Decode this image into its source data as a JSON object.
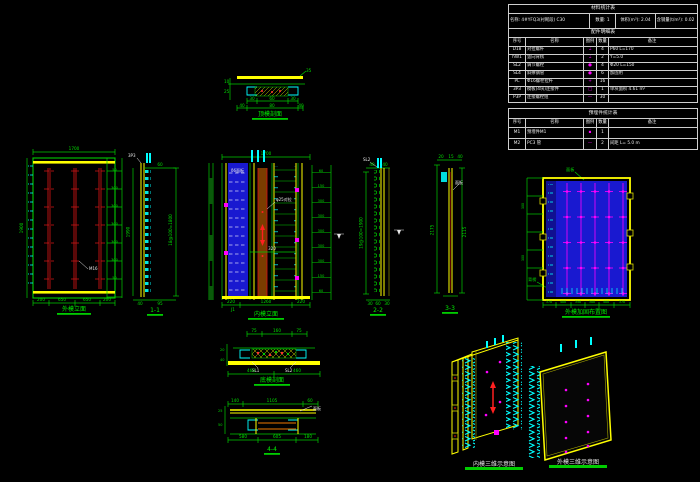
{
  "canvas": {
    "background": "#000000",
    "accent_green": "#00cc00",
    "accent_yellow": "#ffff00",
    "accent_cyan": "#00ffff",
    "accent_blue": "#1919d0",
    "accent_magenta": "#ff00ff",
    "accent_red": "#c81414"
  },
  "tables": {
    "material": {
      "title": "材料统计表",
      "info": [
        "名称: 4#YFQ3(衬砌段) C30",
        "数量: 1",
        "体积(m³): 2.04",
        "含钢量(t/m³): 0.02"
      ],
      "parts_title": "配件明细表",
      "headers": [
        "序号",
        "名称",
        "图例",
        "数量",
        "备注"
      ],
      "rows": [
        {
          "no": "D18",
          "name": "对拉螺杆",
          "glyph": "⌶",
          "qty": "4",
          "note": "P60 L=170"
        },
        {
          "no": "hW1",
          "name": "竖向背楞",
          "glyph": "⌶",
          "qty": "2",
          "note": "Y=5.0"
        },
        {
          "no": "SL2",
          "name": "调节螺栓",
          "glyph": "●",
          "qty": "4",
          "note": "Φ20 L=150"
        },
        {
          "no": "SL4",
          "name": "斜撑钢管",
          "glyph": "●",
          "qty": "6",
          "note": "加固用"
        },
        {
          "no": "PL",
          "name": "Φ16螺栓拉杆",
          "glyph": "+",
          "qty": "16",
          "note": ""
        },
        {
          "no": "3P3",
          "name": "模板(4块)连接件",
          "glyph": "□",
          "qty": "1",
          "note": "单块面积 4.61 m²"
        },
        {
          "no": "P3P",
          "name": "连接螺栓组",
          "glyph": "—",
          "qty": "30",
          "note": ""
        }
      ]
    },
    "embed": {
      "title": "预埋件统计表",
      "headers": [
        "序号",
        "名称",
        "图例",
        "数量",
        "备注"
      ],
      "rows": [
        {
          "no": "M1",
          "name": "预埋件M1",
          "glyph": "▪",
          "qty": "1",
          "note": ""
        },
        {
          "no": "M2",
          "name": "PC3 管",
          "glyph": "—",
          "qty": "2",
          "note": "间距 L= 5.0 m"
        }
      ]
    }
  },
  "drawings": {
    "top_section": {
      "label": "顶模剖面",
      "dims_a": [
        "30",
        "60",
        "30"
      ],
      "dims_b": [
        "40",
        "80",
        "40"
      ],
      "dims_left": [
        "10",
        "25"
      ],
      "leader": "35"
    },
    "left_elev": {
      "label": "外模立面",
      "dim_top": "1700",
      "dim_left": "1900",
      "dims_right": [
        "50",
        "300",
        "300",
        "300",
        "300",
        "300",
        "50"
      ],
      "dims_bottom": [
        "200",
        "650",
        "650",
        "200"
      ],
      "leader": "M16"
    },
    "sec11": {
      "label": "1-1",
      "dim_left": "1990",
      "dim_right": "18@100=1800",
      "dim_top": "60",
      "top_note": "3P3",
      "dims_bottom": [
        "40",
        "95"
      ]
    },
    "mid_elev": {
      "label": "内模立面",
      "dim_top": "1700",
      "dim_mid": "320",
      "dims_right": [
        "60",
        "150",
        "300",
        "300",
        "300",
        "300",
        "300",
        "150",
        "60"
      ],
      "dims_bottom": [
        "220",
        "1260",
        "220"
      ],
      "leader_a": "φ25对拉",
      "leader_b": "δ6面板",
      "note_corner": "J1"
    },
    "sec22": {
      "label": "2-2",
      "dim_left": "19@100=1900",
      "top_note": "SL2",
      "dims_top": [
        "40",
        "40"
      ],
      "dims_bottom": [
        "30",
        "60",
        "30"
      ]
    },
    "sec33": {
      "label": "3-3",
      "dim_left": "2175",
      "dim_right": "2115",
      "dims_top": [
        "20",
        "15",
        "40"
      ],
      "leader": "面板"
    },
    "right_elev": {
      "label": "外模加固布置图",
      "leader_top": "面板",
      "leader_left": "背楞",
      "dims_left": [
        "300",
        "300"
      ],
      "dims_bottom": [
        "370",
        "400",
        "350",
        "300",
        "400",
        "370"
      ]
    },
    "bottom_sec": {
      "label": "底模剖面",
      "dims_top": [
        "75",
        "160",
        "75"
      ],
      "dims_left": [
        "20",
        "40"
      ],
      "dims_bottom": [
        "460",
        "460"
      ],
      "leader_a": "SL1",
      "leader_b": "SL2"
    },
    "sec44": {
      "label": "4-4",
      "dims_top": [
        "140",
        "1105",
        "60"
      ],
      "dims_left": [
        "25",
        "50"
      ],
      "dims_bottom": [
        "580",
        "605",
        "180"
      ],
      "leader": "面板"
    },
    "iso_inner": {
      "label": "内模三维示意图"
    },
    "iso_outer": {
      "label": "外模三维示意图"
    }
  }
}
